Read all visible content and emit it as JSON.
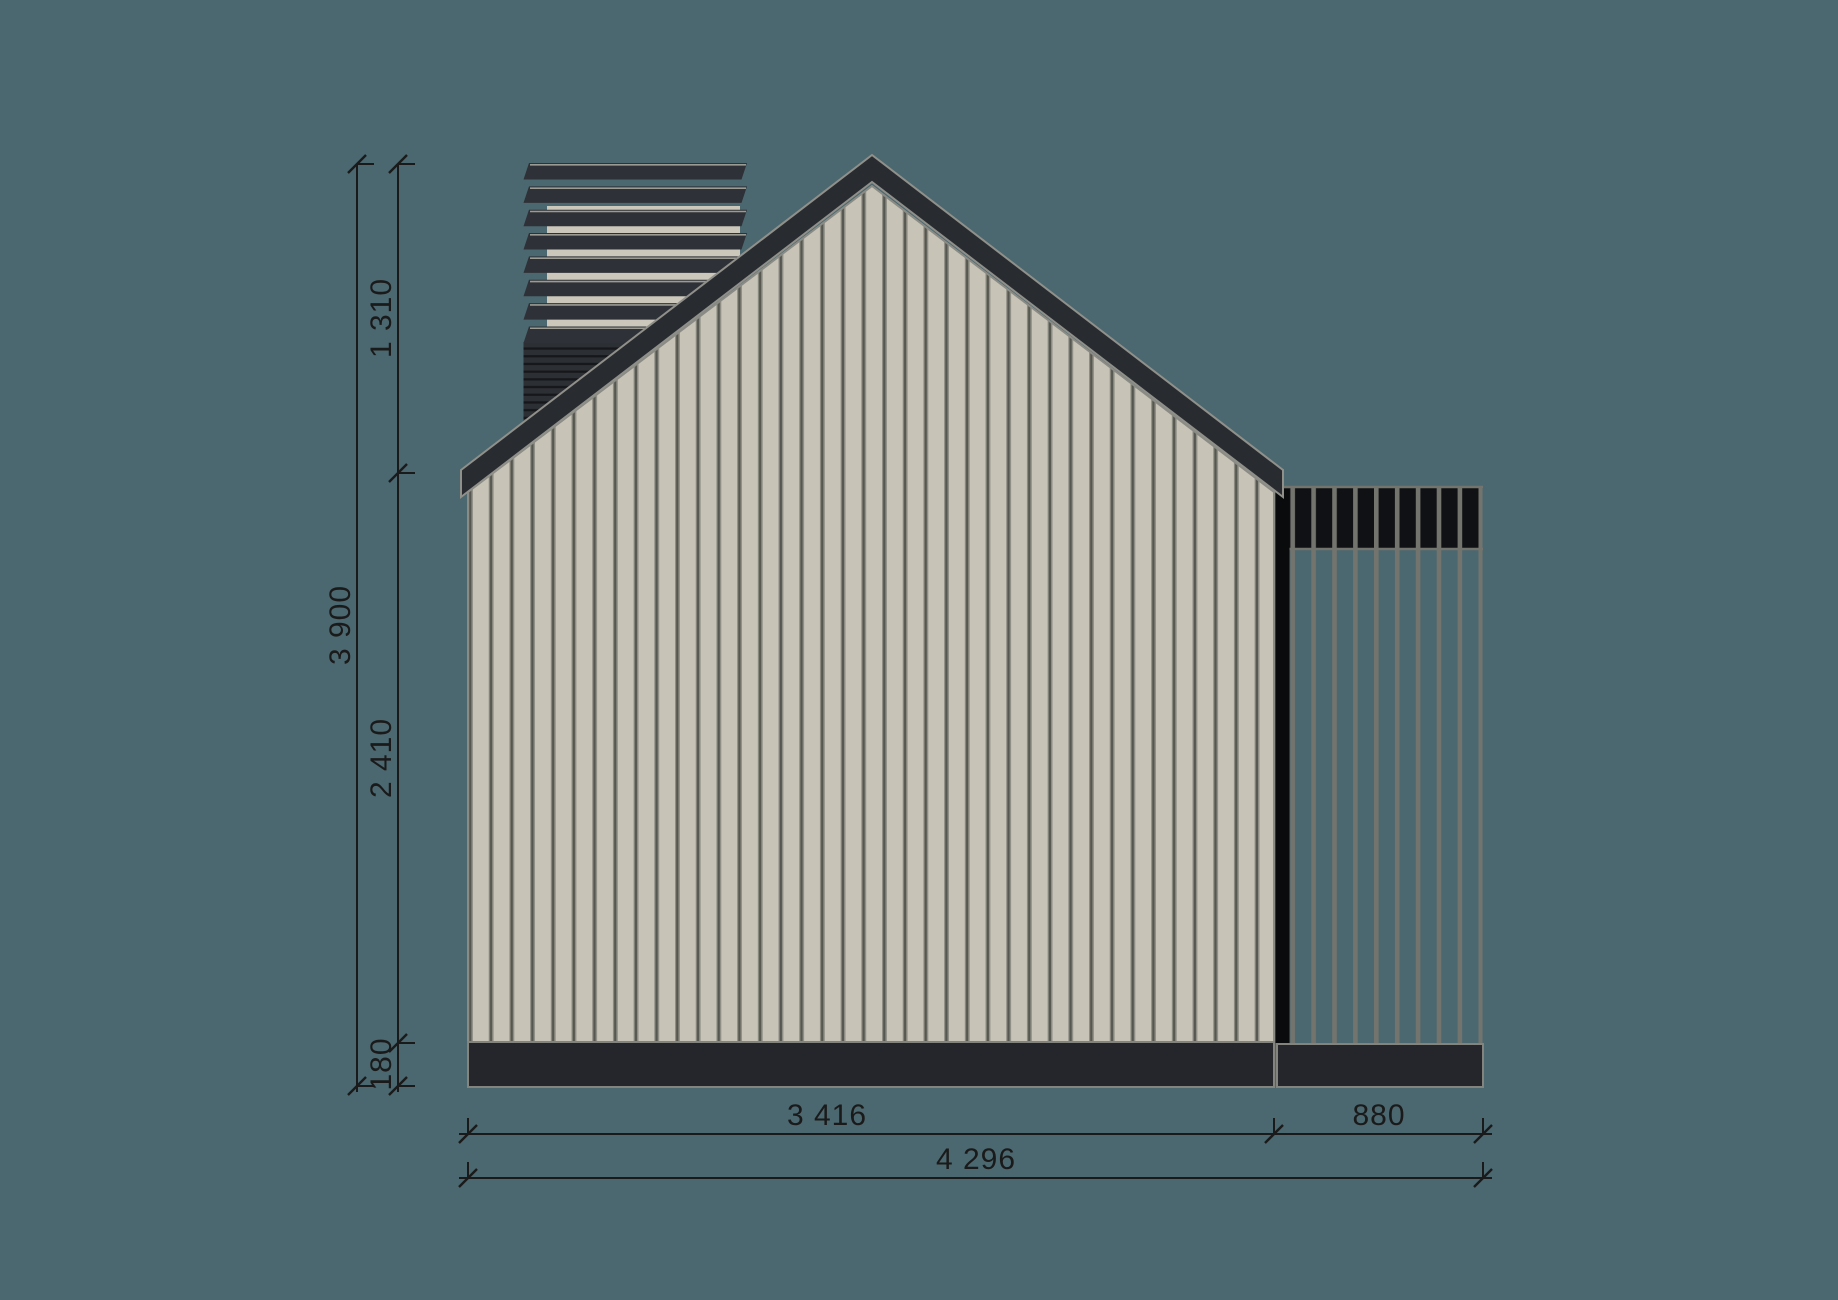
{
  "drawing": {
    "kind": "house-side-elevation"
  },
  "dimensions": {
    "roof_height": "1 310",
    "total_height": "3 900",
    "wall_height": "2 410",
    "plinth_height": "180",
    "house_width": "3 416",
    "pergola_width": "880",
    "total_width": "4 296"
  },
  "colors": {
    "background": "#4b676f",
    "siding": "#c7c3b7",
    "seam-light": "#8e8e84",
    "seam-dark": "#565750",
    "wall-outline": "#8b8b85",
    "roof": "#282b30",
    "roof-outline": "#90908a",
    "plinth": "#24262b",
    "plinth-outline": "#84847e",
    "pergola-dark": "#101114",
    "pergola-frame": "#73746e",
    "black-strip": "#0a0b0d",
    "slat": "#2e3137",
    "slat-edge": "#9b9b94",
    "stack-base": "#2c2f34",
    "stack-stripe": "#15171b",
    "chimney-panel": "#cbc7bb",
    "dim": "#1a1a1a"
  }
}
